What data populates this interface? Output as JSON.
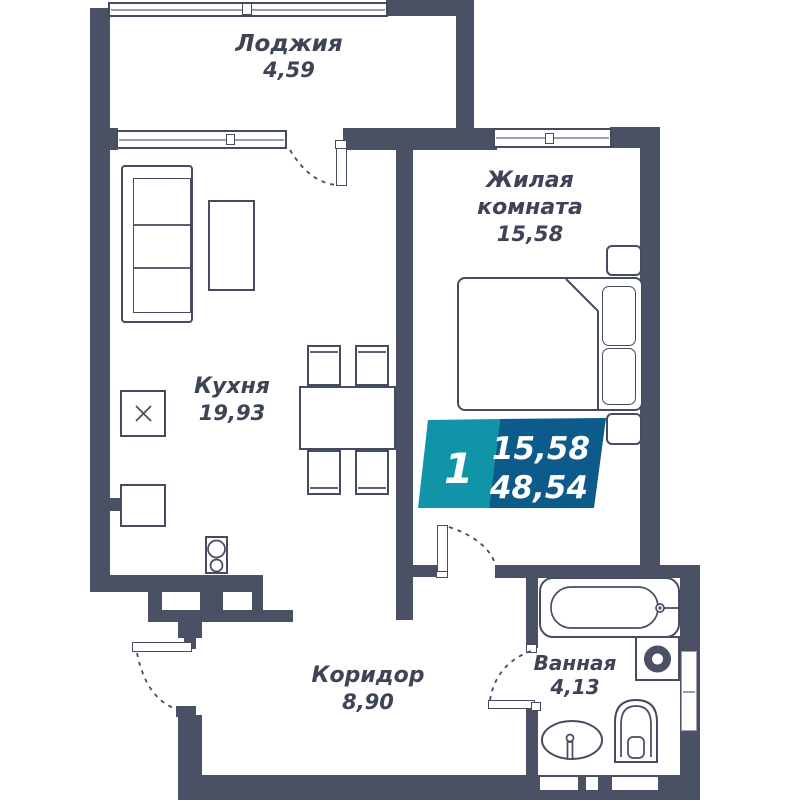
{
  "plan": {
    "title": "1-room apartment floor plan",
    "rooms": [
      {
        "id": "loggia",
        "name": "Лоджия",
        "area": "4,59"
      },
      {
        "id": "living",
        "name": "Жилая комната",
        "area": "15,58"
      },
      {
        "id": "kitchen",
        "name": "Кухня",
        "area": "19,93"
      },
      {
        "id": "corridor",
        "name": "Коридор",
        "area": "8,90"
      },
      {
        "id": "bathroom",
        "name": "Ванная",
        "area": "4,13"
      }
    ],
    "badge": {
      "room_count": "1",
      "living_area": "15,58",
      "total_area": "48,54"
    },
    "colors": {
      "wall": "#4b5164",
      "line": "#454c5f",
      "window_line": "#9aa0ad",
      "text": "#3d4456",
      "badge_teal": "#1095a8",
      "badge_blue": "#0d5b8a",
      "bg": "#ffffff"
    }
  }
}
